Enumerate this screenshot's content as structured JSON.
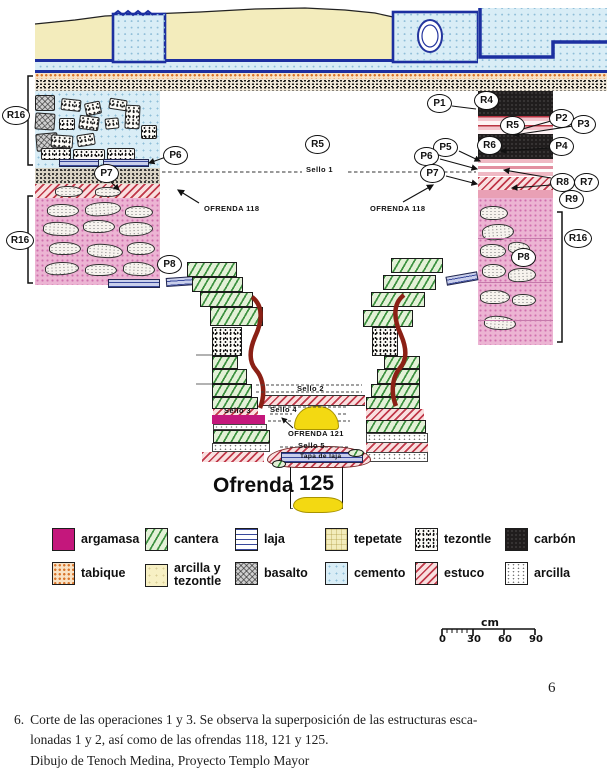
{
  "page": {
    "number": "6"
  },
  "caption": {
    "index": "6.",
    "line1": "Corte de las operaciones 1 y 3. Se observa la superposición de las estructuras esca-",
    "line2": "lonadas 1 y 2, así como de las ofrendas 118, 121 y 125.",
    "line3": "Dibujo de Tenoch Medina, Proyecto Templo Mayor"
  },
  "diagram": {
    "rings": {
      "p1": "P1",
      "p2": "P2",
      "p3": "P3",
      "p4": "P4",
      "p5": "P5",
      "p6": "P6",
      "p7": "P7",
      "p8": "P8",
      "r4": "R4",
      "r5": "R5",
      "r6": "R6",
      "r7": "R7",
      "r8": "R8",
      "r9": "R9",
      "r16": "R16"
    },
    "annotations": {
      "sello1": "Sello 1",
      "sello2": "Sello 2",
      "sello3": "Sello 3",
      "sello4": "Sello 4",
      "sello5": "Sello 5",
      "ofrenda118": "OFRENDA 118",
      "ofrenda121": "OFRENDA 121",
      "tapa_laja": "Tapa de laja",
      "ofrenda125_word": "Ofrenda",
      "ofrenda125_number": "125"
    }
  },
  "legend": {
    "items": [
      {
        "label": "argamasa",
        "pattern": "solid-magenta",
        "color": "#c4177c"
      },
      {
        "label": "cantera",
        "pattern": "green-diagonal-hatch",
        "color": "#348c38"
      },
      {
        "label": "laja",
        "pattern": "blue-horizontal-lines",
        "color": "#39499c"
      },
      {
        "label": "tepetate",
        "pattern": "yellow-crosshatch",
        "color": "#f3ecbc"
      },
      {
        "label": "tezontle",
        "pattern": "black-speckle",
        "color": "#161616"
      },
      {
        "label": "carbón",
        "pattern": "solid-black",
        "color": "#201d1d"
      },
      {
        "label": "tabique",
        "pattern": "orange-dots",
        "color": "#d9762c"
      },
      {
        "label": "arcilla y tezontle",
        "pattern": "pale-yellow",
        "color": "#f7f0c4"
      },
      {
        "label": "basalto",
        "pattern": "gray-crosshatch",
        "color": "#cfcfcf"
      },
      {
        "label": "cemento",
        "pattern": "blue-dots",
        "color": "#d9edf6"
      },
      {
        "label": "estuco",
        "pattern": "red-diagonal-hatch",
        "color": "#c0394a"
      },
      {
        "label": "arcilla",
        "pattern": "sparse-dots",
        "color": "#555555"
      }
    ]
  },
  "scale": {
    "unit": "cm",
    "ticks": [
      "0",
      "30",
      "60",
      "90"
    ]
  }
}
